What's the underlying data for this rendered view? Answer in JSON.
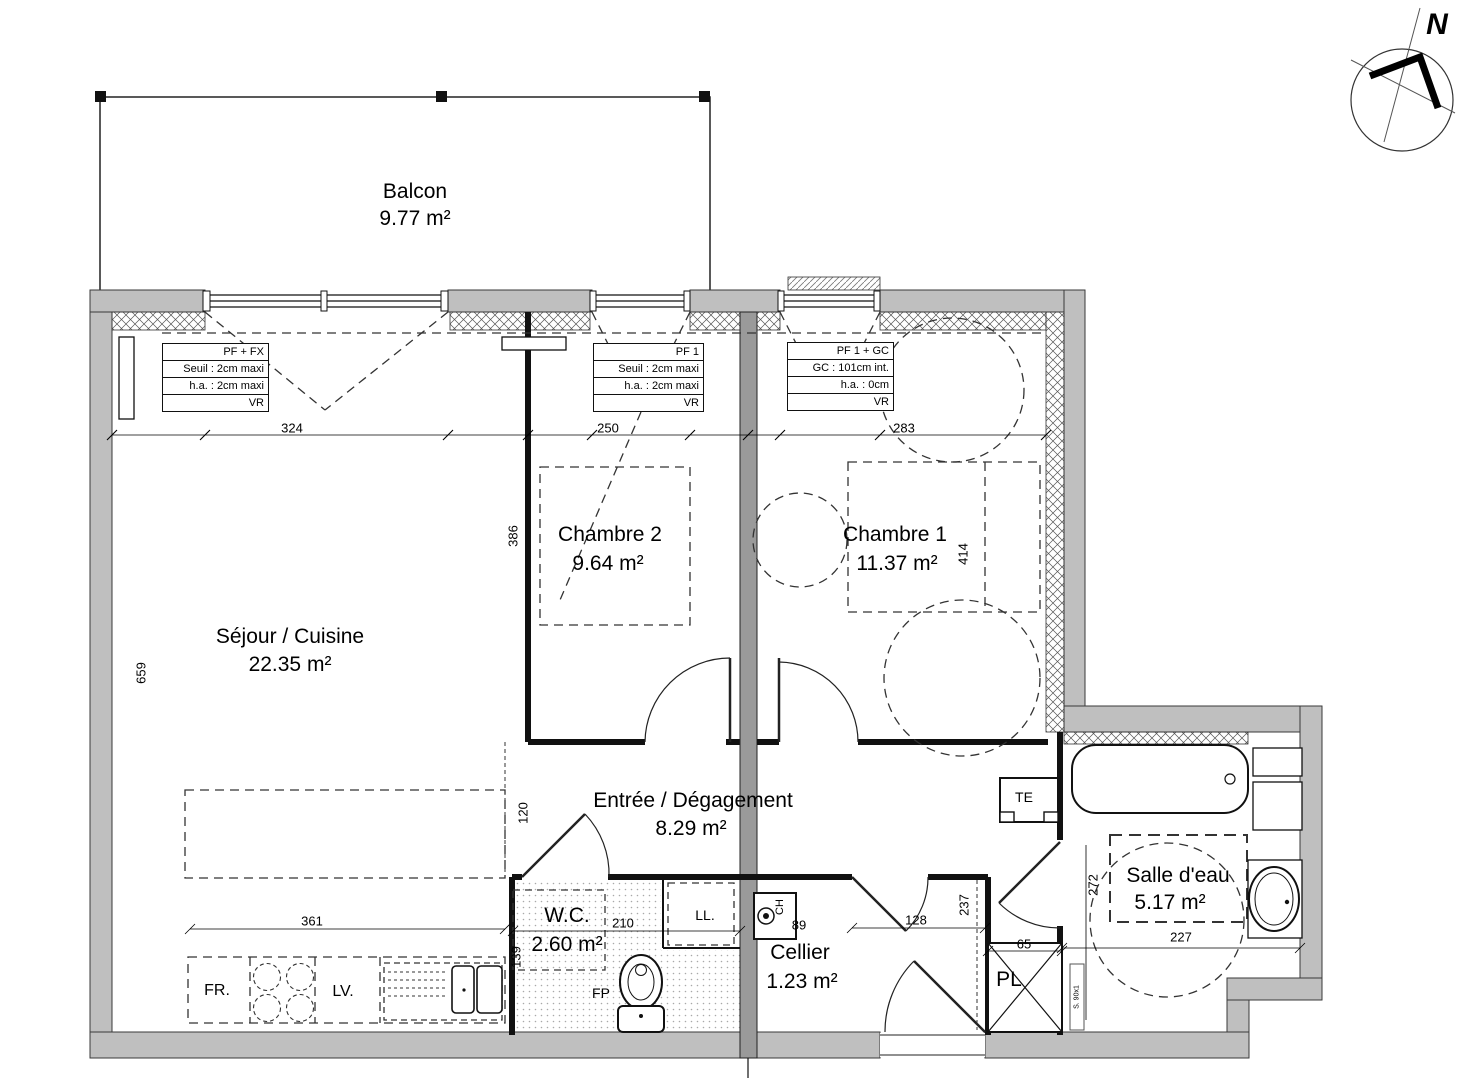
{
  "compass": {
    "label": "N"
  },
  "rooms": {
    "balcon": {
      "name": "Balcon",
      "area": "9.77 m²"
    },
    "sejour": {
      "name": "Séjour / Cuisine",
      "area": "22.35 m²"
    },
    "chambre2": {
      "name": "Chambre 2",
      "area": "9.64 m²"
    },
    "chambre1": {
      "name": "Chambre 1",
      "area": "11.37 m²"
    },
    "entree": {
      "name": "Entrée / Dégagement",
      "area": "8.29 m²"
    },
    "wc": {
      "name": "W.C.",
      "area": "2.60 m²"
    },
    "cellier": {
      "name": "Cellier",
      "area": "1.23 m²"
    },
    "salle_eau": {
      "name": "Salle d'eau",
      "area": "5.17 m²"
    }
  },
  "window_specs": [
    {
      "rows": [
        "PF + FX",
        "Seuil : 2cm maxi",
        "h.a. : 2cm maxi",
        "VR"
      ]
    },
    {
      "rows": [
        "PF 1",
        "Seuil : 2cm maxi",
        "h.a. : 2cm maxi",
        "VR"
      ]
    },
    {
      "rows": [
        "PF 1 + GC",
        "GC : 101cm int.",
        "h.a. : 0cm",
        "VR"
      ]
    }
  ],
  "dims": {
    "win1": "324",
    "win2": "250",
    "win3": "283",
    "sejour_h": "659",
    "ch2_h": "386",
    "ch1_h": "414",
    "entree_h": "120",
    "kitchen_w": "361",
    "kitchen_h": "139",
    "wc_w": "210",
    "ch_w": "89",
    "cellier_w": "128",
    "cellier_h": "237",
    "bain_h": "272",
    "bain_w": "227",
    "pl_w": "65"
  },
  "fixtures": {
    "fr": "FR.",
    "lv": "LV.",
    "fp": "FP",
    "ll": "LL.",
    "ch": "CH",
    "te": "TE",
    "pl": "PL",
    "door_tag": "S. 90x1"
  }
}
